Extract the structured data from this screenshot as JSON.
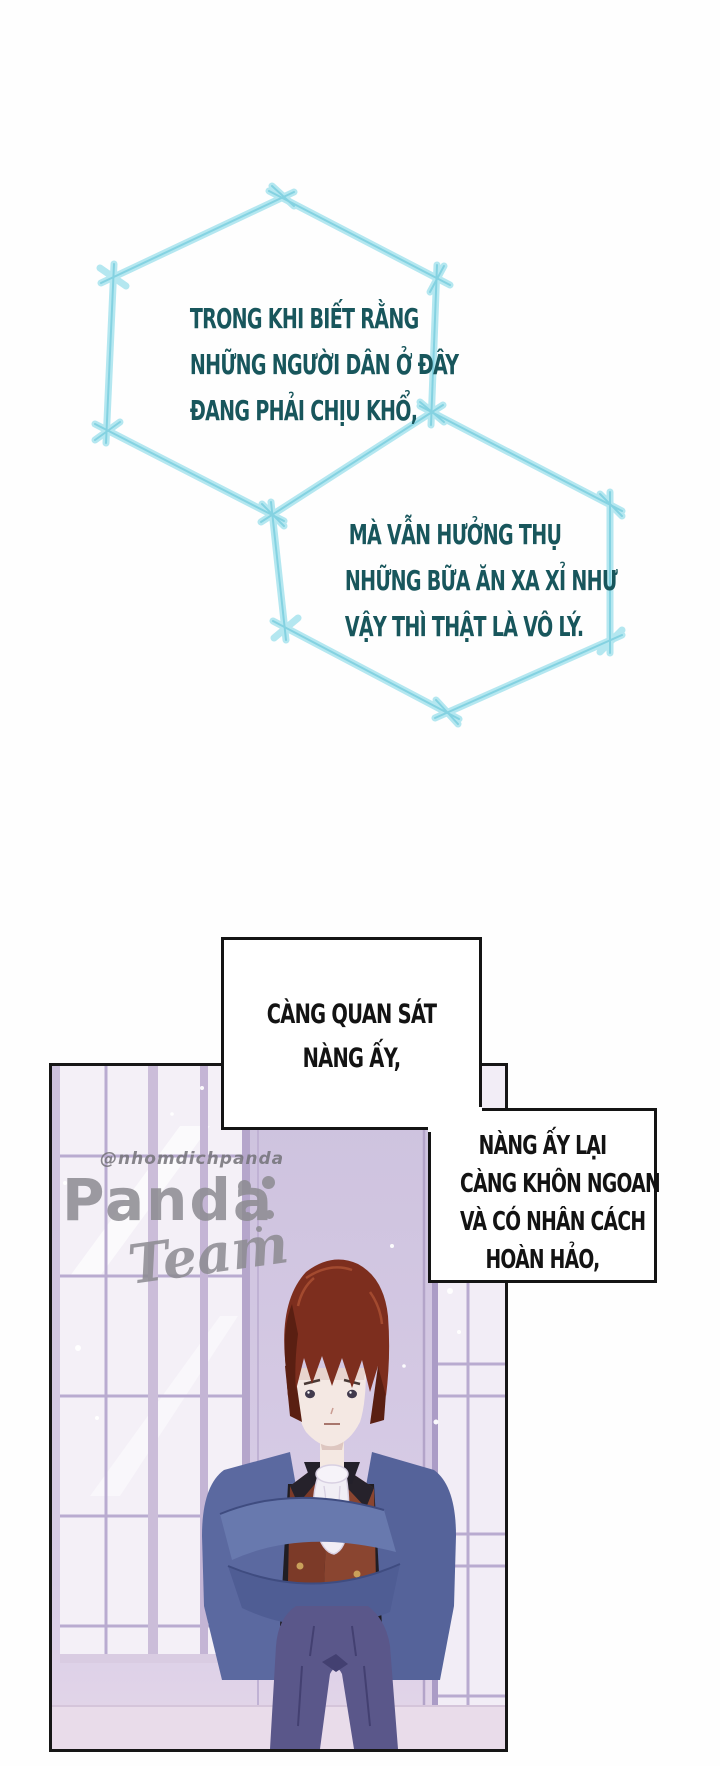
{
  "bubbles": {
    "hex1": {
      "lines": [
        "TRONG KHI BIẾT RẰNG",
        "NHỮNG NGƯỜI DÂN Ở ĐÂY",
        "ĐANG PHẢI CHỊU KHỔ,"
      ]
    },
    "hex2": {
      "lines": [
        "MÀ VẪN HƯỞNG THỤ",
        "NHỮNG BỮA ĂN XA XỈ NHƯ",
        "VẬY THÌ THẬT LÀ VÔ LÝ."
      ]
    },
    "rect1": {
      "lines": [
        "CÀNG QUAN SÁT",
        "NÀNG ẤY,"
      ]
    },
    "rect2": {
      "lines": [
        "NÀNG ẤY LẠI",
        "CÀNG KHÔN NGOAN",
        "VÀ CÓ NHÂN CÁCH",
        "HOÀN HẢO,"
      ]
    }
  },
  "watermark": {
    "handle": "@nhomdichpanda",
    "title": "Panda",
    "subtitle": "Team"
  },
  "colors": {
    "hex_border_outer": "#b4e7f0",
    "hex_border_core": "#7fd0e0",
    "hex_text": "#18565c",
    "bubble_border": "#141414",
    "bubble_text": "#131313",
    "panel_border": "#161616",
    "watermark_gray": "#8c8b91",
    "wall_lavender": "#cfc4e0",
    "window_white": "#f4f0f7",
    "hair_auburn": "#7d2e1e",
    "jacket_blue": "#5b69a0",
    "vest_brown": "#7c3a28",
    "pants_indigo": "#5a578a"
  }
}
